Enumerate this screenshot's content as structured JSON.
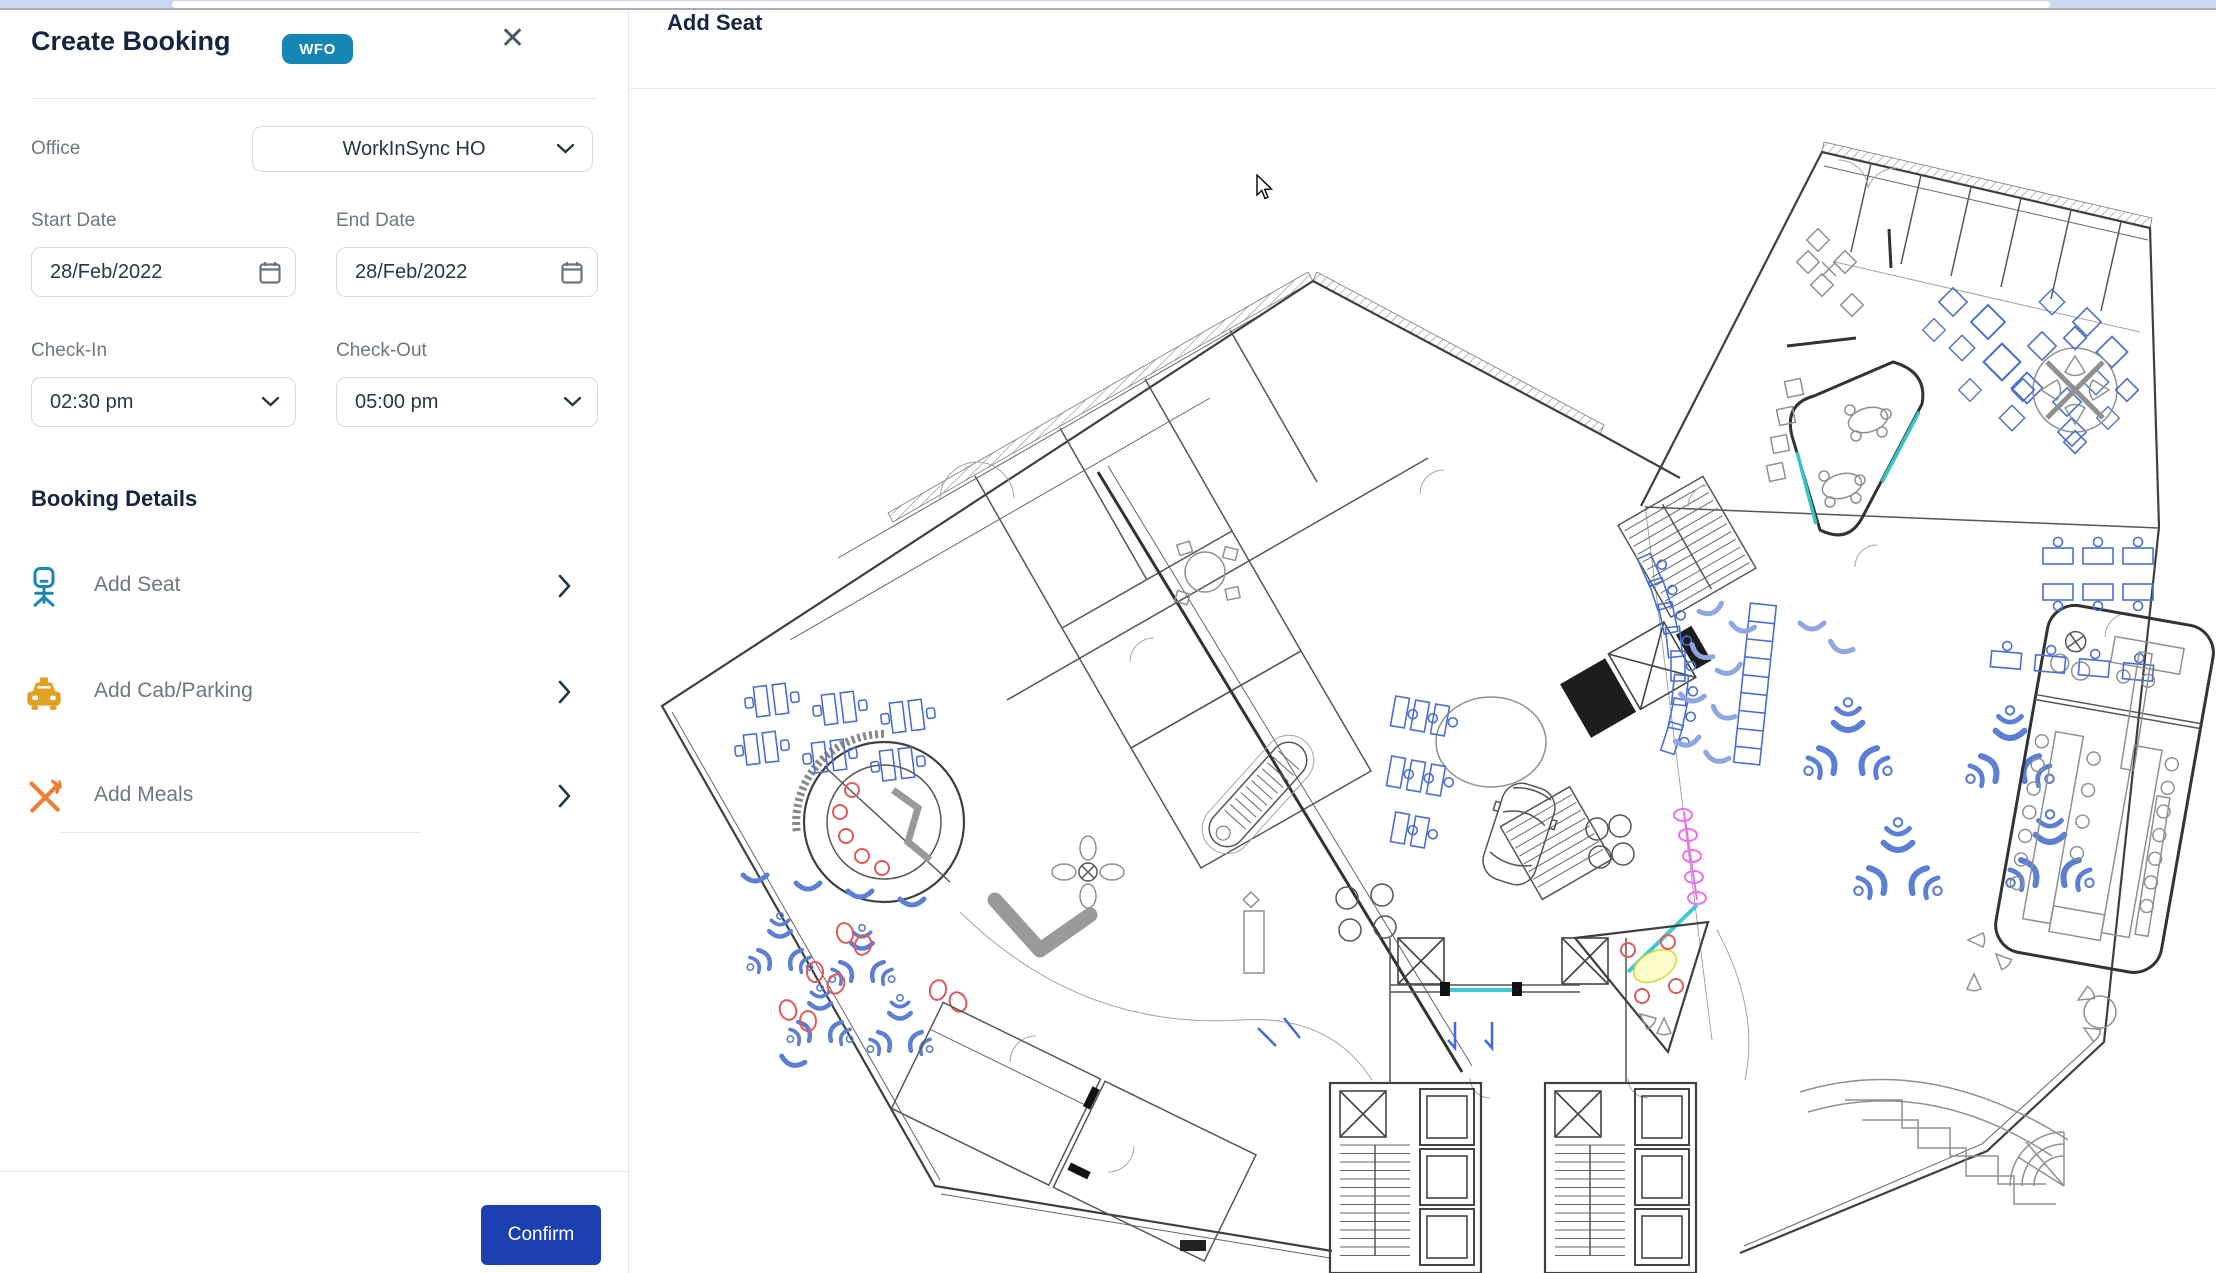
{
  "booking_panel": {
    "title": "Create Booking",
    "badge": "WFO",
    "close_icon": "✕",
    "office": {
      "label": "Office",
      "value": "WorkInSync HO"
    },
    "start_date": {
      "label": "Start Date",
      "value": "28/Feb/2022"
    },
    "end_date": {
      "label": "End Date",
      "value": "28/Feb/2022"
    },
    "check_in": {
      "label": "Check-In",
      "value": "02:30 pm"
    },
    "check_out": {
      "label": "Check-Out",
      "value": "05:00 pm"
    },
    "details": {
      "heading": "Booking Details",
      "items": [
        {
          "label": "Add Seat",
          "icon": "office-chair-icon"
        },
        {
          "label": "Add Cab/Parking",
          "icon": "taxi-icon"
        },
        {
          "label": "Add Meals",
          "icon": "fork-knife-icon"
        }
      ]
    },
    "confirm_label": "Confirm"
  },
  "seat_panel": {
    "title": "Add Seat",
    "my_office": {
      "label": "My Office",
      "icon": "building-icon"
    },
    "search": {
      "placeholder": "Search Colleague"
    },
    "filter_icon": "sliders-icon",
    "floorplan": "office-floor-plan"
  },
  "colors": {
    "badge_teal": "#1587b2",
    "confirm_blue": "#1c40af",
    "seat_icon_teal": "#1b87b8",
    "cab_icon_orange": "#dfa024",
    "meals_icon_orange": "#ef7d35",
    "heading_navy": "#16243f",
    "label_gray": "#6e7680",
    "plan_blue": "#4a6fd0",
    "plan_lightblue": "#8fa6e4",
    "plan_red": "#e05a5a",
    "plan_pink": "#ee6ff0",
    "plan_cyan": "#3fc9d6",
    "plan_yellow": "#e6e66a"
  }
}
